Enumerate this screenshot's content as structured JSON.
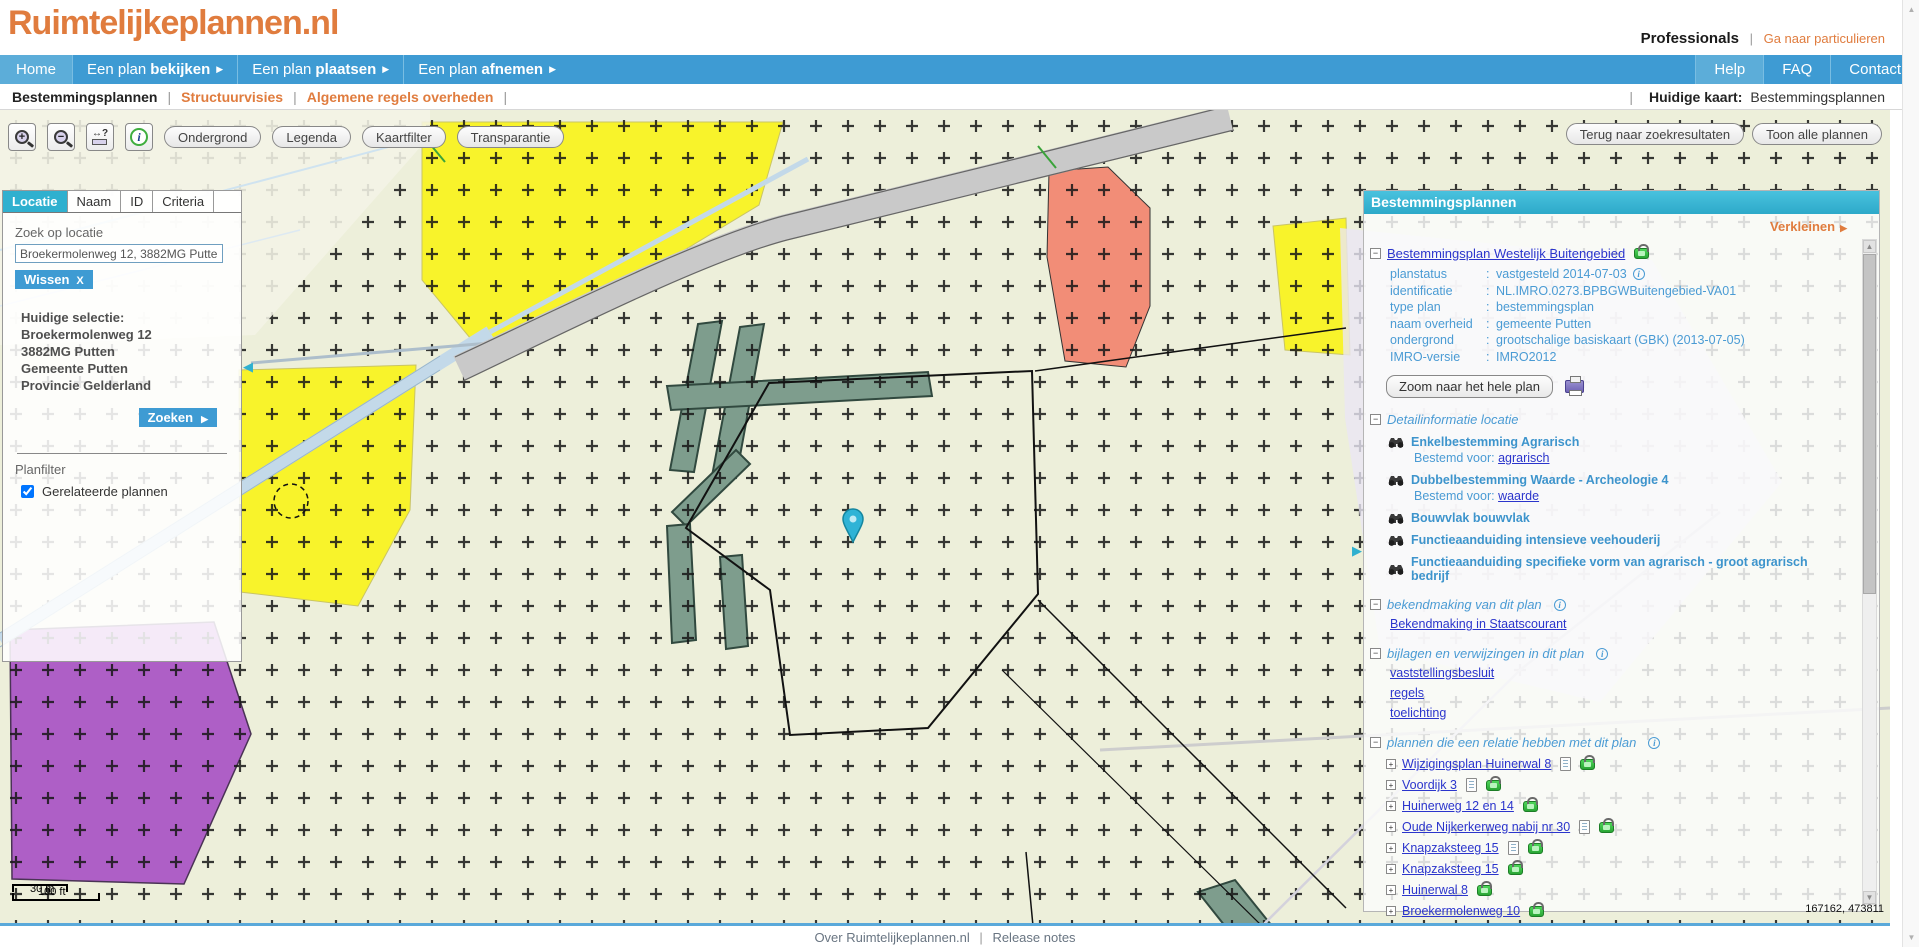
{
  "header": {
    "logo": "Ruimtelijkeplannen.nl",
    "audience": "Professionals",
    "audience_link": "Ga naar particulieren"
  },
  "nav": {
    "items": [
      {
        "prefix": "Home",
        "bold": ""
      },
      {
        "prefix": "Een plan ",
        "bold": "bekijken"
      },
      {
        "prefix": "Een plan ",
        "bold": "plaatsen"
      },
      {
        "prefix": "Een plan ",
        "bold": "afnemen"
      }
    ],
    "right_items": [
      "Help",
      "FAQ",
      "Contact"
    ]
  },
  "subnav": {
    "items": [
      "Bestemmingsplannen",
      "Structuurvisies",
      "Algemene regels overheden"
    ],
    "current_label": "Huidige kaart:",
    "current_value": "Bestemmingsplannen"
  },
  "toolbar": {
    "map_buttons": [
      "Ondergrond",
      "Legenda",
      "Kaartfilter",
      "Transparantie"
    ],
    "right_buttons": [
      "Terug naar zoekresultaten",
      "Toon alle plannen"
    ]
  },
  "search_panel": {
    "tabs": [
      "Locatie",
      "Naam",
      "ID",
      "Criteria"
    ],
    "active_tab": "Locatie",
    "search_label": "Zoek op locatie",
    "search_value": "Broekermolenweg 12, 3882MG Putten",
    "clear_button": "Wissen",
    "clear_x": "X",
    "selection_title": "Huidige selectie:",
    "selection_lines": [
      "Broekermolenweg 12",
      "3882MG Putten",
      "Gemeente Putten",
      "Provincie Gelderland"
    ],
    "search_button": "Zoeken",
    "filter_title": "Planfilter",
    "filter_option": "Gerelateerde plannen",
    "filter_checked": true
  },
  "plan_panel": {
    "title": "Bestemmingsplannen",
    "collapse_label": "Verkleinen",
    "plan_title": "Bestemmingsplan Westelijk Buitengebied",
    "details": [
      {
        "label": "planstatus",
        "value": "vastgesteld 2014-07-03"
      },
      {
        "label": "identificatie",
        "value": "NL.IMRO.0273.BPBGWBuitengebied-VA01"
      },
      {
        "label": "type plan",
        "value": "bestemmingsplan"
      },
      {
        "label": "naam overheid",
        "value": "gemeente Putten"
      },
      {
        "label": "ondergrond",
        "value": "grootschalige basiskaart (GBK) (2013-07-05)"
      },
      {
        "label": "IMRO-versie",
        "value": "IMRO2012"
      }
    ],
    "zoom_button": "Zoom naar het hele plan",
    "detail_section": "Detailinformatie locatie",
    "features": [
      {
        "title": "Enkelbestemming Agrarisch",
        "sub_label": "Bestemd voor:",
        "sub_link": "agrarisch"
      },
      {
        "title": "Dubbelbestemming Waarde - Archeologie 4",
        "sub_label": "Bestemd voor:",
        "sub_link": "waarde"
      },
      {
        "title": "Bouwvlak bouwvlak"
      },
      {
        "title": "Functieaanduiding intensieve veehouderij"
      },
      {
        "title": "Functieaanduiding specifieke vorm van agrarisch - groot agrarisch bedrijf"
      }
    ],
    "announcement_section": "bekendmaking van dit plan",
    "announcement_link": "Bekendmaking in Staatscourant",
    "attachments_section": "bijlagen en verwijzingen in dit plan",
    "attachment_links": [
      "vaststellingsbesluit",
      "regels",
      "toelichting"
    ],
    "related_section": "plannen die een relatie hebben met dit plan",
    "related_plans": [
      {
        "label": "Wijzigingsplan Huinerwal 8",
        "has_doc": true
      },
      {
        "label": "Voordijk 3",
        "has_doc": true
      },
      {
        "label": "Huinerweg 12 en 14",
        "has_doc": false
      },
      {
        "label": "Oude Nijkerkerweg nabij nr 30",
        "has_doc": true
      },
      {
        "label": "Knapzaksteeg 15",
        "has_doc": true
      },
      {
        "label": "Knapzaksteeg 15",
        "has_doc": false
      },
      {
        "label": "Huinerwal 8",
        "has_doc": false
      },
      {
        "label": "Broekermolenweg 10",
        "has_doc": false
      },
      {
        "label": "Huinerweg 12 en 14",
        "has_doc": true
      },
      {
        "label": "Kraakweg 3a en Telgterweg 24a",
        "has_doc": false
      }
    ]
  },
  "map": {
    "scale_metric": "30 m",
    "scale_imperial": "100 ft",
    "coordinates": "167162, 473811"
  },
  "footer": {
    "links": [
      "Over Ruimtelijkeplannen.nl",
      "Release notes"
    ]
  },
  "glyphs": {
    "arrow_right": "▶",
    "arrow_left": "◀",
    "up": "▲",
    "down": "▼",
    "pipe": "|",
    "colon": ":",
    "minus": "−",
    "plus": "+",
    "info": "i",
    "zoom_in": "+",
    "zoom_out": "−",
    "measure": "↔?"
  },
  "colors": {
    "brand_orange": "#e07c3e",
    "nav_blue": "#3e9bd3",
    "panel_cyan": "#35b4d1",
    "link_blue": "#2b35cc",
    "label_blue": "#4a9bd4",
    "lock_green": "#35c33f",
    "map_yellow": "#f8f32b",
    "map_salmon": "#f28d77",
    "map_purple": "#ae5fc6",
    "map_sage": "#7e9d8d"
  }
}
